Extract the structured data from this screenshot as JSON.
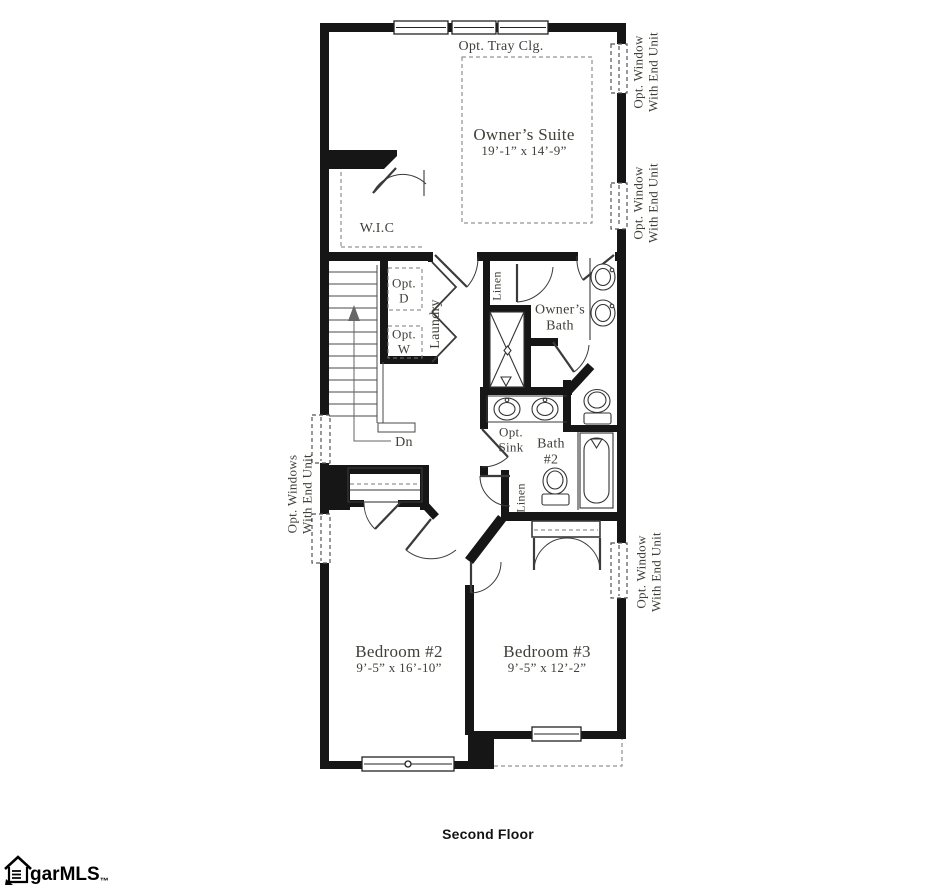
{
  "plan": {
    "floor_title": "Second Floor",
    "rooms": {
      "owners_suite": {
        "name": "Owner’s Suite",
        "dims": "19’-1” x 14’-9”"
      },
      "bedroom2": {
        "name": "Bedroom #2",
        "dims": "9’-5” x 16’-10”"
      },
      "bedroom3": {
        "name": "Bedroom #3",
        "dims": "9’-5” x 12’-2”"
      },
      "wic": "W.I.C",
      "laundry": "Laundry",
      "owners_bath": {
        "line1": "Owner’s",
        "line2": "Bath"
      },
      "bath2": {
        "line1": "Bath",
        "line2": "#2"
      },
      "linen_upper": "Linen",
      "linen_lower": "Linen"
    },
    "annotations": {
      "tray_ceiling": "Opt. Tray Clg.",
      "opt_dryer": {
        "line1": "Opt.",
        "line2": "D"
      },
      "opt_washer": {
        "line1": "Opt.",
        "line2": "W"
      },
      "opt_sink": {
        "line1": "Opt.",
        "line2": "Sink"
      },
      "stairs_down": "Dn",
      "opt_window_right_top": {
        "line1": "Opt. Window",
        "line2": "With End Unit"
      },
      "opt_window_right_mid": {
        "line1": "Opt. Window",
        "line2": "With End Unit"
      },
      "opt_window_right_bottom": {
        "line1": "Opt. Window",
        "line2": "With End Unit"
      },
      "opt_windows_left": {
        "line1": "Opt. Windows",
        "line2": "With End Unit"
      }
    }
  },
  "watermark": {
    "brand": "garMLS",
    "trademark": "™"
  }
}
